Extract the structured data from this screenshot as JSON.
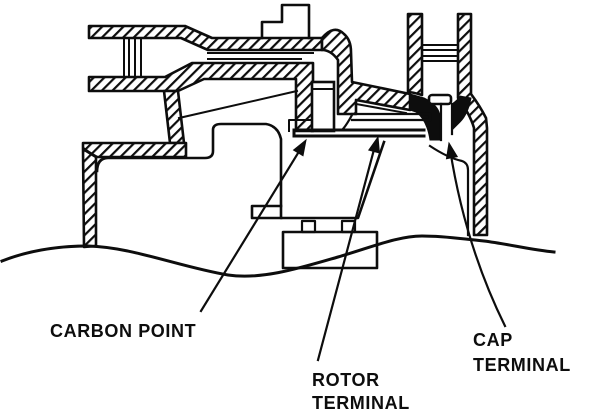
{
  "figure": {
    "type": "distributor-cap-cross-section-diagram",
    "labels": {
      "carbon_point": {
        "text": "CARBON POINT"
      },
      "rotor_terminal": {
        "line1": "ROTOR",
        "line2": "TERMINAL"
      },
      "cap_terminal": {
        "line1": "CAP",
        "line2": "TERMINAL"
      }
    },
    "colors": {
      "ink": "#0d0d0d",
      "background": "#ffffff"
    }
  }
}
